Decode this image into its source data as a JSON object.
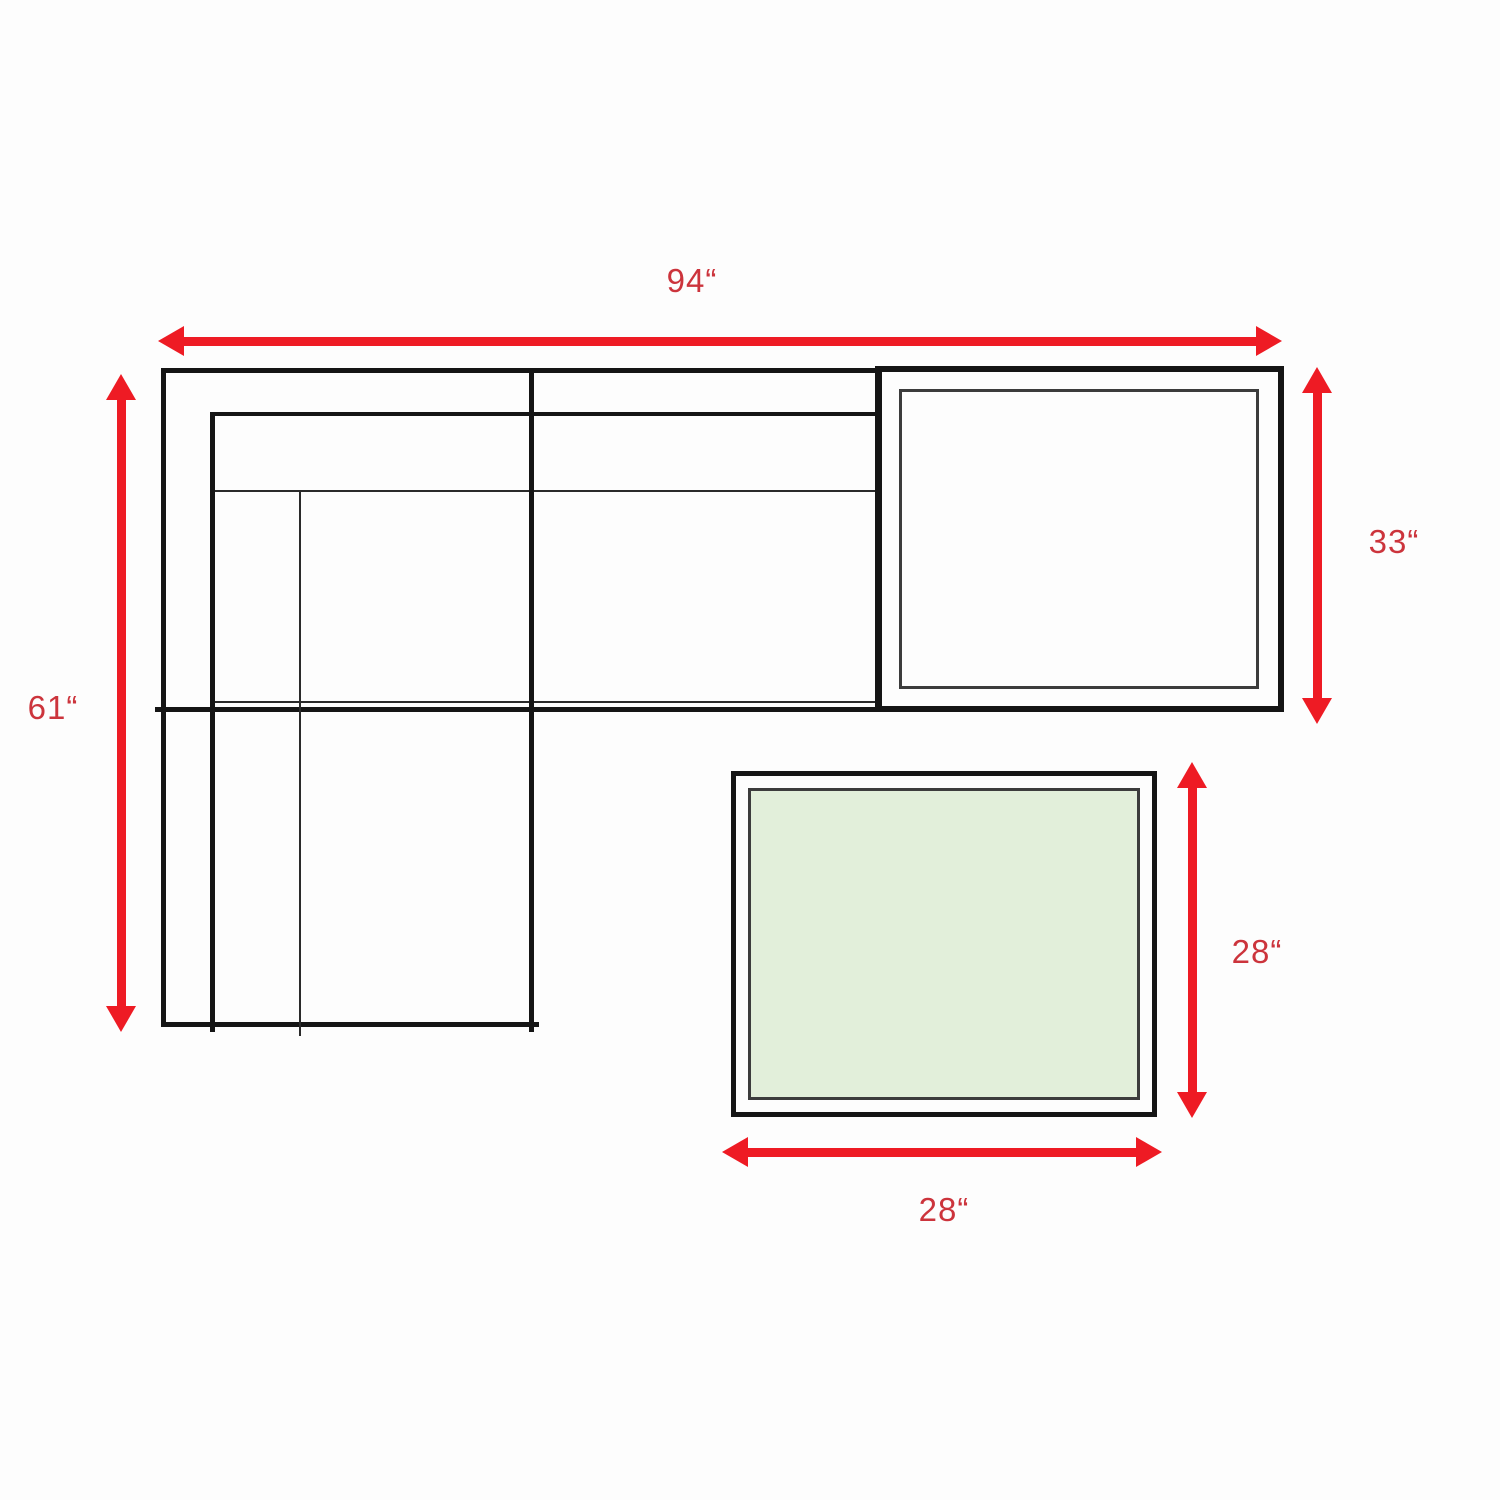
{
  "background": "#fdfdfd",
  "colors": {
    "arrow_red": "#ee1b24",
    "label_red": "#cc343c",
    "outline_black": "#151515",
    "inner_line_gray": "#3c3c3c",
    "ottoman_fill": "#e2efda"
  },
  "diagram": {
    "type": "furniture-dimension-plan",
    "description": "Sectional sofa with chaise, corner end table and ottoman, top view with dimensions",
    "labels": {
      "overall_width": "94“",
      "overall_depth": "61“",
      "corner_table_depth": "33“",
      "ottoman_depth": "28“",
      "ottoman_width": "28“"
    }
  }
}
